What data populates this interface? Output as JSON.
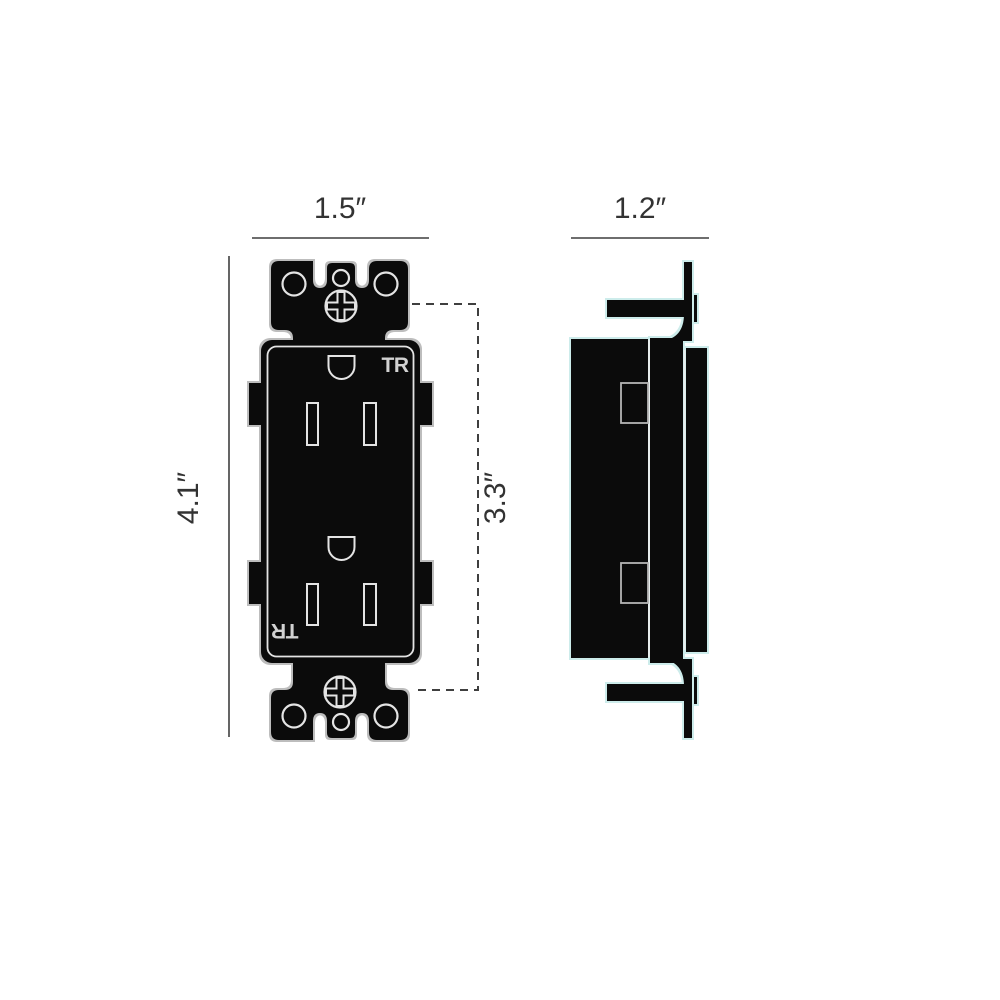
{
  "diagram": {
    "type": "technical dimension drawing",
    "subject": "tamper-resistant duplex receptacle outlet, front and side views",
    "front_view": {
      "width_dim": "1.5″",
      "height_dim": "4.1″",
      "opening_height_dim": "3.3″",
      "marking_top": "TR",
      "marking_bottom": "TR"
    },
    "side_view": {
      "depth_dim": "1.2″"
    },
    "colors": {
      "ink": "#0b0b0b",
      "front_outline_halo": "#bdbdbd",
      "side_outline_halo": "#cdeceb",
      "detail_stroke": "#e4e4e4",
      "dimension_line": "#3f3f3f",
      "label_text": "#333333"
    }
  }
}
